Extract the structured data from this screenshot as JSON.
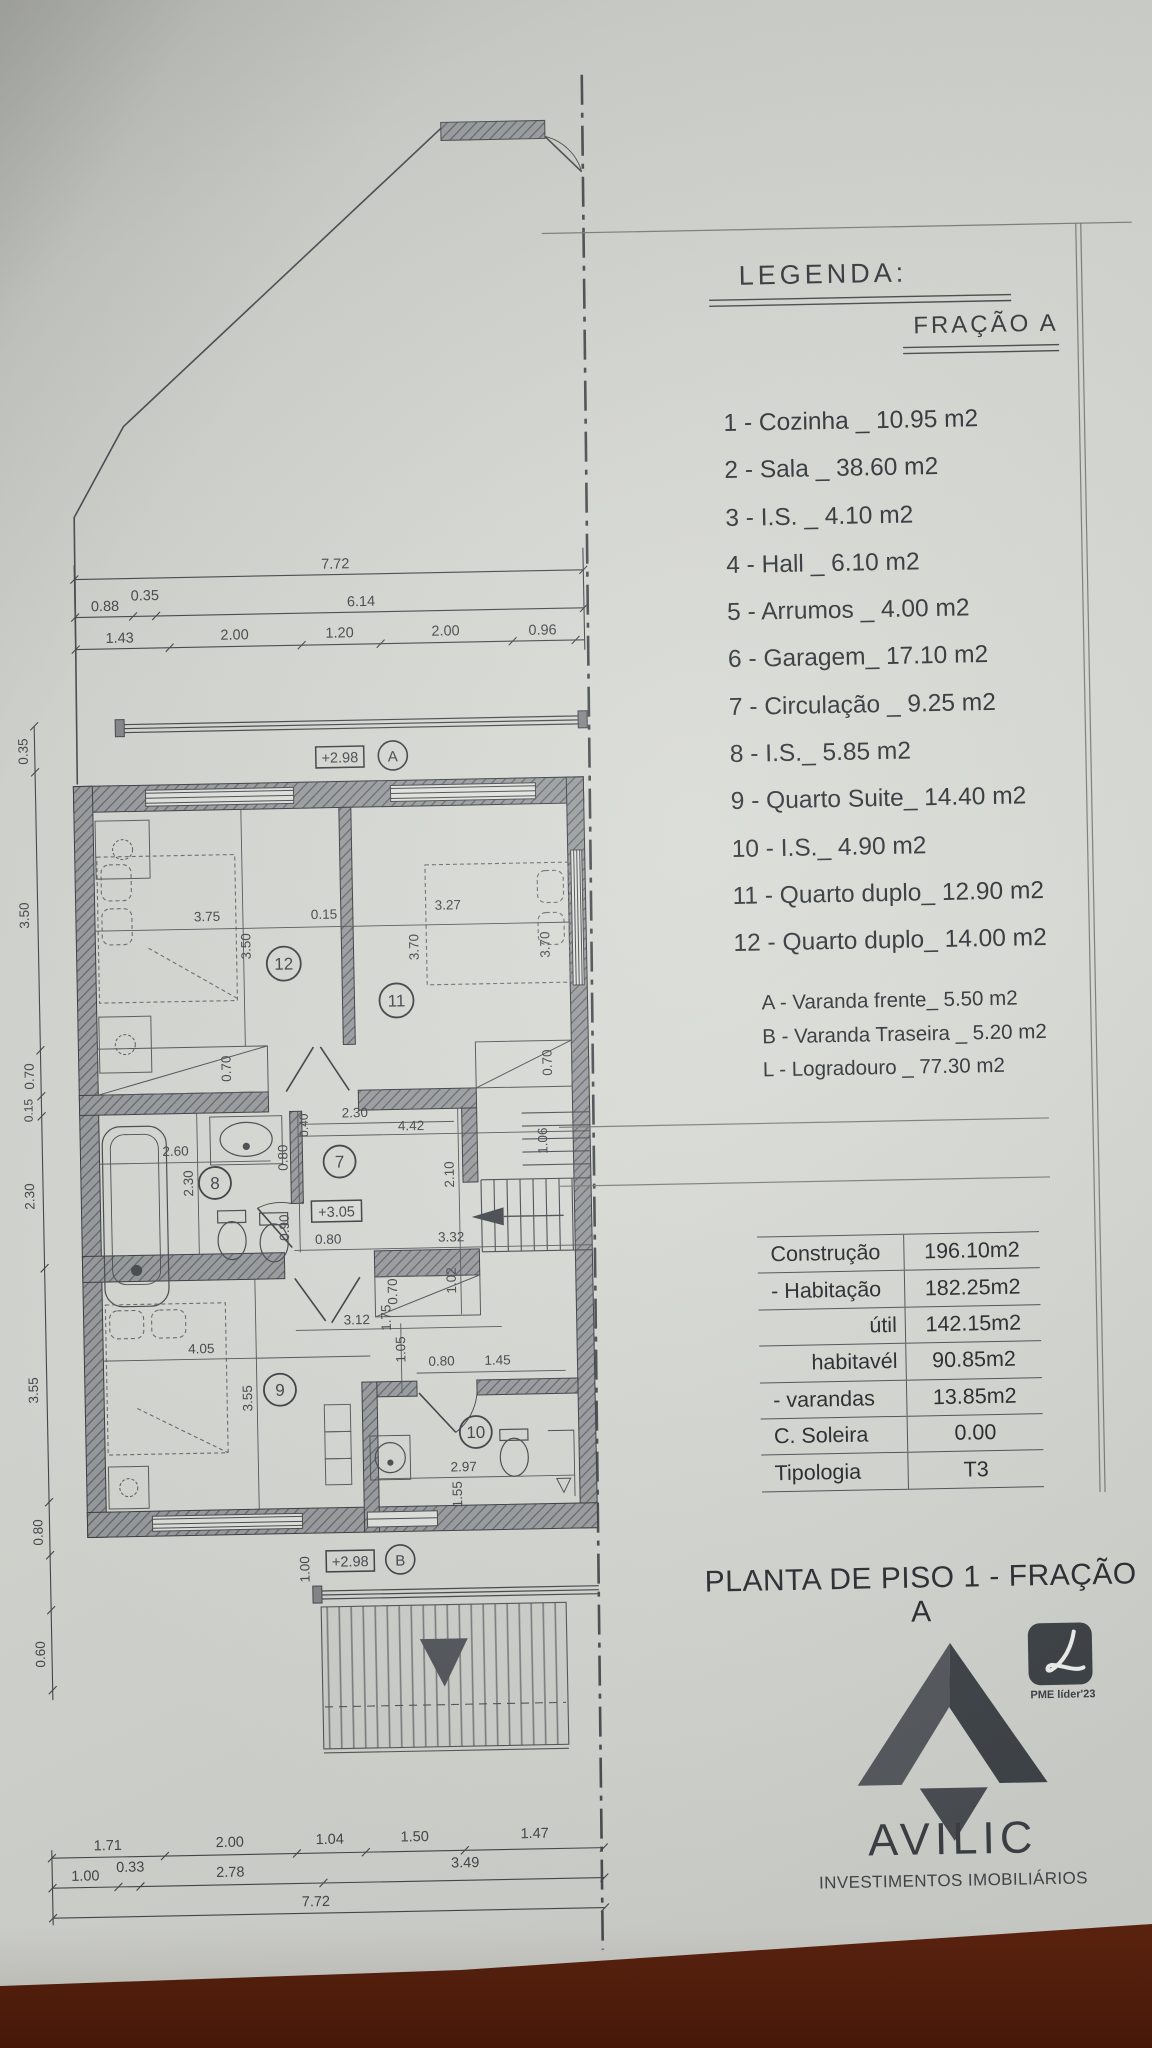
{
  "legend": {
    "title": "LEGENDA:",
    "subtitle": "FRAÇÃO A",
    "items": [
      "1 - Cozinha _ 10.95 m2",
      "2 - Sala  _ 38.60 m2",
      "3 - I.S. _ 4.10 m2",
      "4 - Hall _ 6.10 m2",
      "5 - Arrumos _ 4.00 m2",
      "6 - Garagem_ 17.10 m2",
      "7 - Circulação _ 9.25 m2",
      "8 - I.S._ 5.85 m2",
      "9 - Quarto Suite_ 14.40 m2",
      "10 - I.S._ 4.90 m2",
      "11 - Quarto duplo_ 12.90 m2",
      "12 - Quarto duplo_ 14.00 m2"
    ],
    "annex_items": [
      "A - Varanda frente_ 5.50 m2",
      "B - Varanda Traseira _ 5.20 m2",
      "L - Logradouro _ 77.30 m2"
    ]
  },
  "areas_table": {
    "rows": [
      {
        "label": "Construção",
        "value": "196.10m2"
      },
      {
        "label": "- Habitação",
        "value": "182.25m2"
      },
      {
        "label": "útil",
        "value": "142.15m2"
      },
      {
        "label": "habitavél",
        "value": "90.85m2"
      },
      {
        "label": "- varandas",
        "value": "13.85m2"
      },
      {
        "label": "C. Soleira",
        "value": "0.00"
      },
      {
        "label": "Tipologia",
        "value": "T3"
      }
    ]
  },
  "title": "PLANTA DE PISO 1 - FRAÇÃO A",
  "brand": {
    "name": "AVILIC",
    "tagline": "INVESTIMENTOS IMOBILIÁRIOS",
    "badge_label": "PME líder'23",
    "logo_dark": "#3f4449",
    "logo_light": "#565a5f"
  },
  "plan": {
    "levels": {
      "a": "+2.98",
      "mid": "+3.05",
      "b": "+2.98"
    },
    "markers": {
      "a": "A",
      "b": "B"
    },
    "rooms": {
      "r12": "12",
      "r11": "11",
      "r8": "8",
      "r7": "7",
      "r9": "9",
      "r10": "10"
    },
    "dims_top": [
      "7.72",
      "0.88",
      "0.35",
      "6.14",
      "1.43",
      "2.00",
      "1.20",
      "2.00",
      "0.96"
    ],
    "dims_left": [
      "0.35",
      "3.50",
      "0.70",
      "0.15",
      "2.30",
      "3.55",
      "0.80",
      "0.60"
    ],
    "dims_bottom_r1": [
      "1.71",
      "2.00",
      "1.04",
      "1.50",
      "1.47"
    ],
    "dims_bottom_r2": [
      "1.00",
      "0.33",
      "2.78",
      "3.49"
    ],
    "dims_bottom_r3": [
      "7.72"
    ],
    "dims_inner": {
      "w12": "3.75",
      "wall015": "0.15",
      "w11": "3.27",
      "h12": "3.50",
      "h11a": "3.70",
      "h11b": "3.70",
      "rec_l": "0.70",
      "rec_r": "0.70",
      "rec_b": "0.70",
      "bw": "2.60",
      "bh": "2.30",
      "c040": "0.40",
      "c230": "2.30",
      "c442": "4.42",
      "c080a": "0.80",
      "c090": "0.90",
      "c080b": "0.80",
      "c332": "3.32",
      "s210": "2.10",
      "s102": "1.02",
      "s106": "1.06",
      "w9": "4.05",
      "h9": "3.55",
      "c312": "3.12",
      "v175": "1.75",
      "v105": "1.05",
      "d080": "0.80",
      "d145": "1.45",
      "d297": "2.97",
      "v155": "1.55",
      "v100": "1.00"
    }
  }
}
